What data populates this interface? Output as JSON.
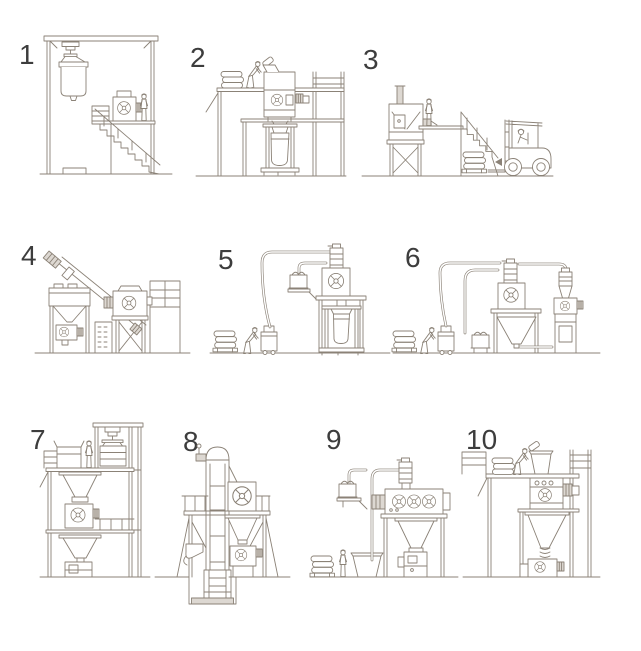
{
  "figure": {
    "type": "equipment-configuration-line-drawings",
    "line_color": "#8b8277",
    "number_color": "#3d3d3d",
    "background": "#ffffff"
  },
  "scenes": [
    {
      "number": "1",
      "name": "big-bag-discharge-gantry-with-stair-platform-and-feeder"
    },
    {
      "number": "2",
      "name": "mezzanine-manual-bag-dump-feeding-big-bag-filling-below"
    },
    {
      "number": "3",
      "name": "platform-hopper-unit-with-forklift-delivering-palletized-bags"
    },
    {
      "number": "4",
      "name": "bag-dump-hopper-with-flexible-screw-conveyor-to-feeder"
    },
    {
      "number": "5",
      "name": "floor-bag-dump-vacuum-conveying-to-feeder-and-big-bag-filling"
    },
    {
      "number": "6",
      "name": "floor-bag-dump-vacuum-conveying-to-two-receivers-and-feeders"
    },
    {
      "number": "7",
      "name": "multi-floor-tower-with-big-bag-hoist-hoppers-and-feeders"
    },
    {
      "number": "8",
      "name": "bucket-elevator-with-pit-boot-feeding-platform-receiver"
    },
    {
      "number": "9",
      "name": "floor-hopper-vacuum-conveying-to-mill-and-packing-machine"
    },
    {
      "number": "10",
      "name": "mezzanine-bag-dump-with-hopper-to-floor-feeder"
    }
  ]
}
